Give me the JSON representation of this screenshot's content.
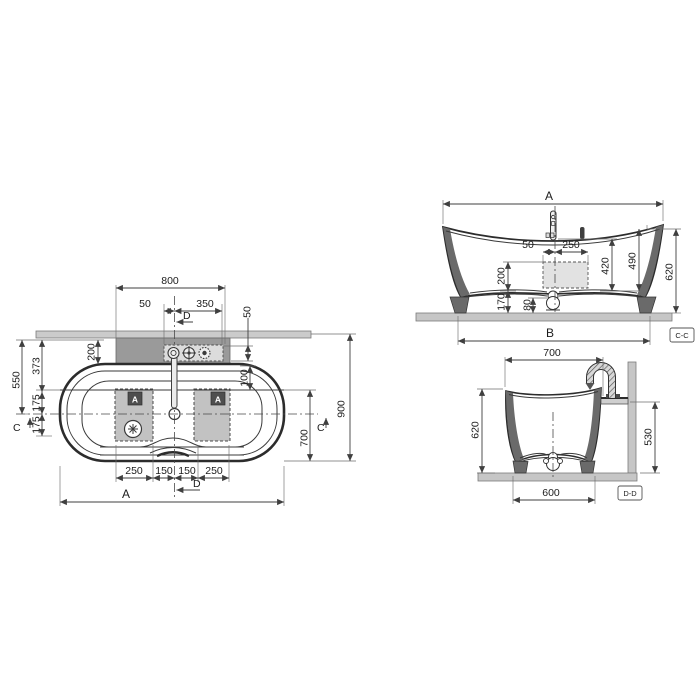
{
  "drawing": {
    "type": "bathtub technical drawing, three orthographic views",
    "colors": {
      "line": "#2c2c2c",
      "dim_line": "#3f3f3f",
      "deck_band": "#cbcbcb",
      "faucet_deck": "#9a9a9a",
      "fitting_strip": "#dcdcdc",
      "jet_panel": "#c2c2c2",
      "badge": "#4e4e4e",
      "floor_wall": "#c6c6c6",
      "cut_wall": "#6a6a6a",
      "pump_box": "#e2e2e2"
    },
    "icons": {
      "pump": "asterisk-star-in-circle",
      "drain": "circle-with-crosshair",
      "faucet_fitting_1": "ring-with-spout",
      "faucet_fitting_2": "crosshair-ring",
      "faucet_fitting_3": "dotted-ring"
    }
  },
  "plan": {
    "deck_width": "800",
    "faucet_left": "50",
    "faucet_right": "350",
    "strip_height": "50",
    "deck_depth": "200",
    "rim_offset": "373",
    "center_offset": "550",
    "jet_upper": "175",
    "jet_lower": "175",
    "rim_inner": "100",
    "inner_depth": "700",
    "overall_depth": "900",
    "panel_left_width": "250",
    "gap_left": "150",
    "gap_right": "150",
    "panel_right_width": "250",
    "overall_width": "A",
    "section_d": "D",
    "section_c": "C",
    "panel_badge": "A"
  },
  "section_cc": {
    "overall": "A",
    "offset_left": "50",
    "offset_right": "250",
    "pump_height": "200",
    "base_height": "170",
    "drain_height": "80",
    "inner_height": "420",
    "rim_height": "490",
    "total_height": "620",
    "base_width": "B",
    "tag": "C-C"
  },
  "section_dd": {
    "width": "700",
    "height": "620",
    "wall_height": "530",
    "base_width": "600",
    "tag": "D-D"
  }
}
